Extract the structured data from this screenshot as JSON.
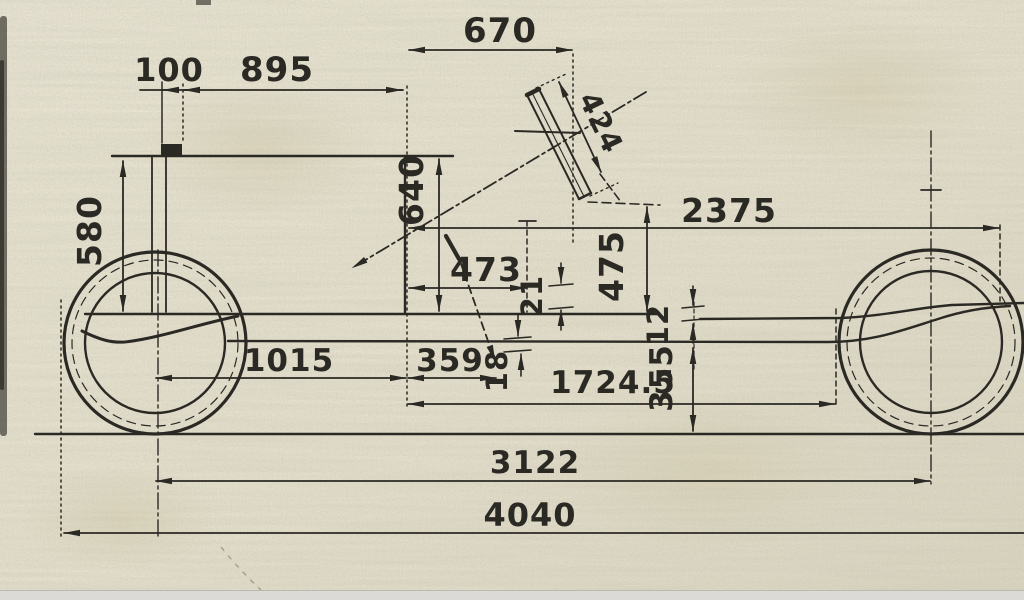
{
  "palette": {
    "paper": "#e8e3d0",
    "ink": "#2b2924"
  },
  "dims": {
    "d100": "100",
    "d895": "895",
    "d670": "670",
    "d424": "424",
    "d580": "580",
    "d640": "640",
    "d473": "473",
    "d2375": "2375",
    "d475": "475",
    "d21": "21",
    "d12": "12",
    "d1015": "1015",
    "d359": "359",
    "d18": "18",
    "d1724_5": "1724.5",
    "d355": "355",
    "d3122": "3122",
    "d4040": "4040"
  }
}
